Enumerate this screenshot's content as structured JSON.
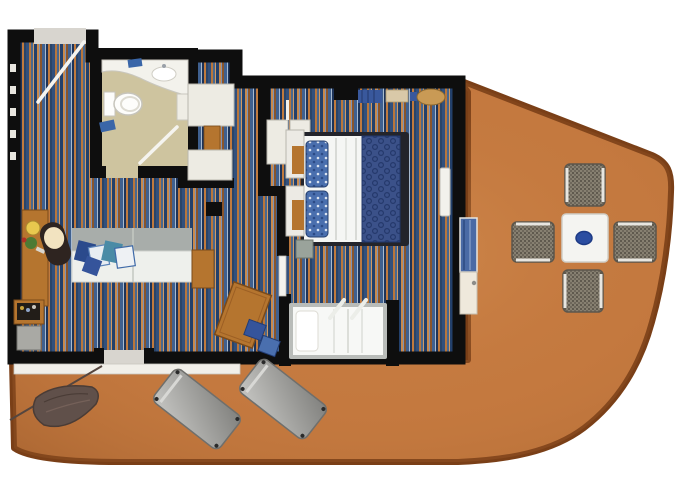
{
  "scene": {
    "type": "cruise-cabin-floor-plan",
    "view": "top-down",
    "background": "#ffffff"
  },
  "colors": {
    "wall": "#0e0e0e",
    "deck": "#c4793f",
    "deck_rail": "#7a3f17",
    "bathroom_floor": "#cec49f",
    "counter_white": "#f3f2ec",
    "fixture_white": "#fdfdfb",
    "towel_blue": "#3a66a8",
    "wood": "#b5752f",
    "wood_dark": "#7a4a1a",
    "closet_white": "#edebe3",
    "sofa_back": "#a8adaa",
    "sofa_seat": "#eef0ec",
    "pillow_blue": "#2b4a8c",
    "pillow_print": "#4a8ba6",
    "duvet_blue": "#3b5189",
    "duvet_swirl": "#24386b",
    "sheet_white": "#f5f6f4",
    "bed_frame": "#23242b",
    "single_bed_frame": "#b9bcb9",
    "table_white": "#f4f4f1",
    "bowl_blue": "#2b4da1",
    "chair_mesh": "#878071",
    "lounger_grey": "#9b9b98",
    "hammock_brown": "#60504a",
    "threshold_grey": "#d8d5cf",
    "sill_white": "#f1efe9",
    "chair_seat_cream": "#f2e3c0",
    "chair_body_dark": "#2e2420",
    "plant_green": "#4d7a34",
    "lamp_yellow": "#e8c84e",
    "door_panel_blue": "#4a6aa5",
    "door_panel_cream": "#efe9dc"
  },
  "carpet_palette": [
    "#2a4468",
    "#32507c",
    "#b9763b",
    "#49688f",
    "#d19a63",
    "#23406b",
    "#c98a4d",
    "#7e93b5",
    "#8a552b",
    "#3f608f",
    "#a8bacf",
    "#1d3358",
    "#c07a3e"
  ],
  "rooms": [
    {
      "name": "entry-hall"
    },
    {
      "name": "bathroom"
    },
    {
      "name": "living-room"
    },
    {
      "name": "bedroom"
    },
    {
      "name": "single-bed-nook"
    },
    {
      "name": "balcony"
    }
  ],
  "furniture": {
    "balcony_dining_chairs": 4,
    "balcony_table": 1,
    "table_centerpiece_bowl": 1,
    "sun_loungers": 2,
    "hammock": 1,
    "queen_bed": 1,
    "single_bed": 1,
    "sofa": 1,
    "sofa_pillows": 5,
    "desk": 1,
    "desk_chair": 1,
    "dining_table": 1,
    "dining_cushions": 2,
    "wardrobes": 5,
    "nightstands": 2,
    "toilet": 1,
    "sink": 1
  }
}
